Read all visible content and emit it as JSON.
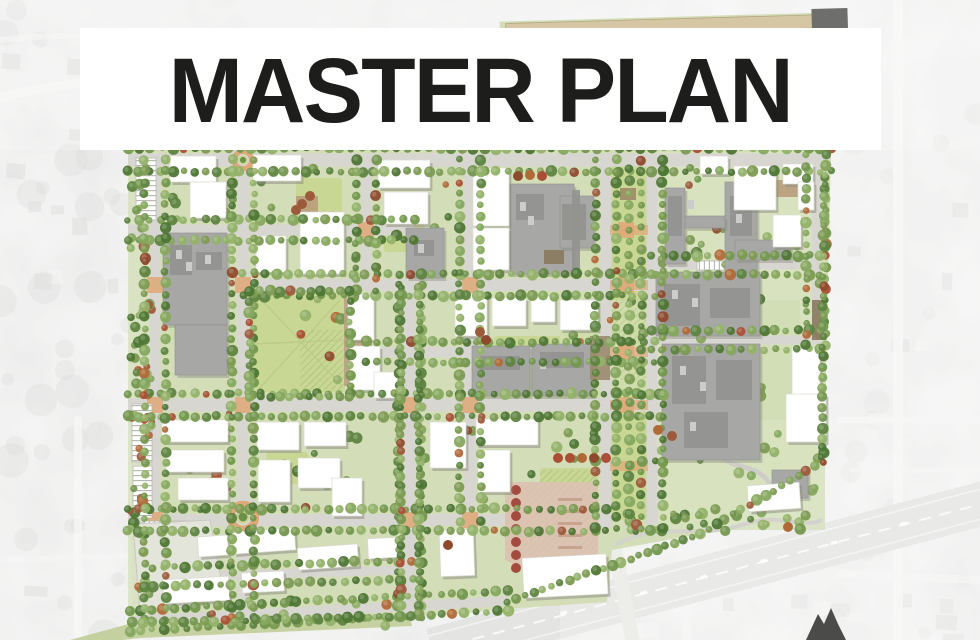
{
  "title": {
    "text": "MASTER PLAN"
  },
  "palette": {
    "banner_bg": "#ffffff",
    "title_color": "#1d1d1b",
    "aerial_base": "#d8d8d6",
    "aerial_road": "#f0f0ee",
    "plan_block_green": "#d3ddb8",
    "lawn_green": "#c9d795",
    "campus_green": "#d8e2c0",
    "street_gray": "#d8d6d1",
    "paving_tan": "#dfa878",
    "tree_greens": [
      "#73974d",
      "#5e8440",
      "#86a85e",
      "#4e7634",
      "#93b269",
      "#7c9b52"
    ],
    "tree_rusts": [
      "#9d5a3b",
      "#aa4f33",
      "#8e4a2c",
      "#b06a38"
    ],
    "building_white": "#ffffff",
    "building_shadow": "#8a8a7e",
    "building_gray": "#a7a7a5",
    "building_gray_dark": "#929290",
    "plaza_pink": "#dcc3b2",
    "parking_stripe": "#b9b9b3",
    "highway_gray": "#d0d0ce",
    "marker_dark": "#4b4b49"
  }
}
